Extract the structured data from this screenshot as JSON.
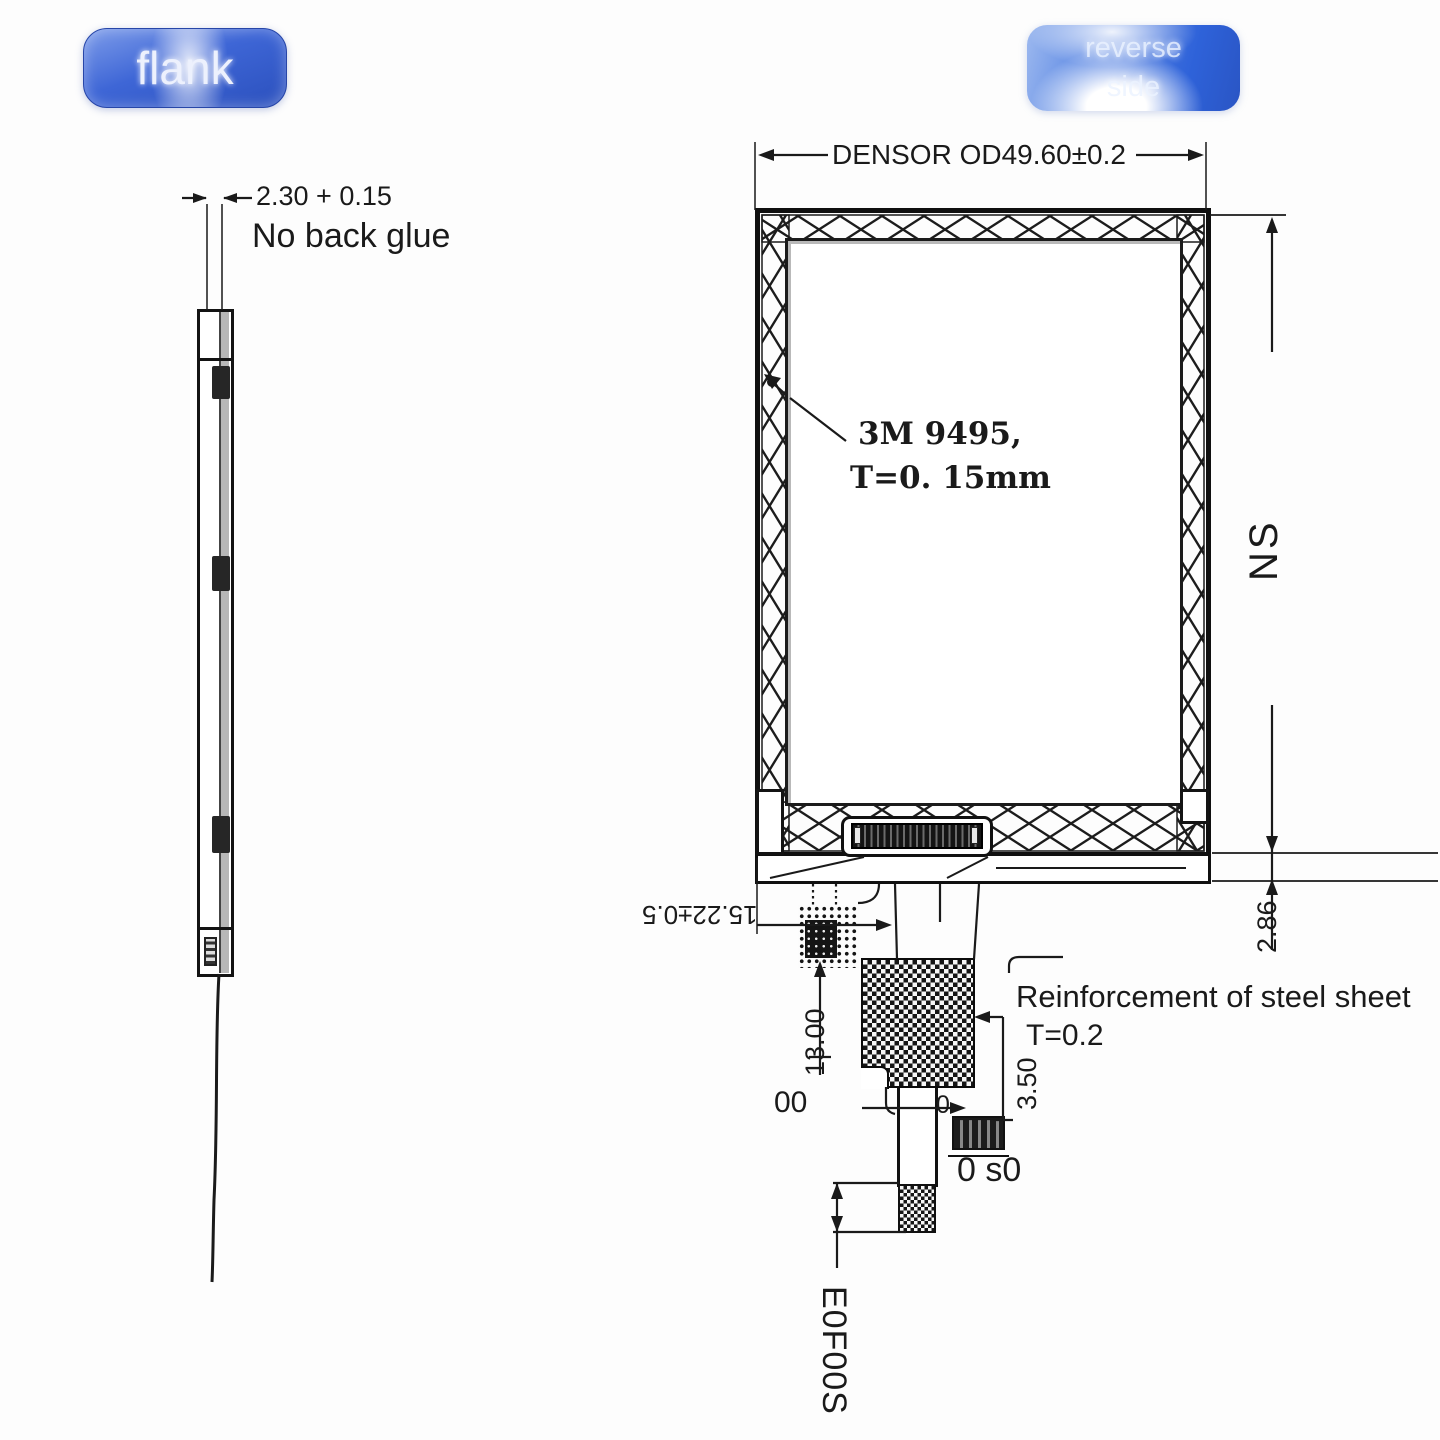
{
  "colors": {
    "accent_blue": "#3a63d2",
    "line_dark": "#1a1a1a"
  },
  "tags": {
    "flank": "flank",
    "reverse": "reverse side"
  },
  "side_view": {
    "thickness_dim": "2.30 + 0.15",
    "note": "No back glue"
  },
  "front_view": {
    "width_dim": "DENSOR OD49.60±0.2",
    "adhesive_line1": "3M 9495,",
    "adhesive_line2": "T=0. 15mm",
    "height_label": "NS",
    "bottom_thickness_dim": "2.86"
  },
  "fpc": {
    "offset_dim": "15.22±0.5",
    "length_dim": "13.00",
    "label_00": "00",
    "reinforcement_line1": "Reinforcement of steel sheet",
    "reinforcement_line2": "T=0.2",
    "connector_height_dim": "3.50",
    "label_zero": "0",
    "connector_label": "0 s0",
    "tail_label": "E0F00S"
  }
}
